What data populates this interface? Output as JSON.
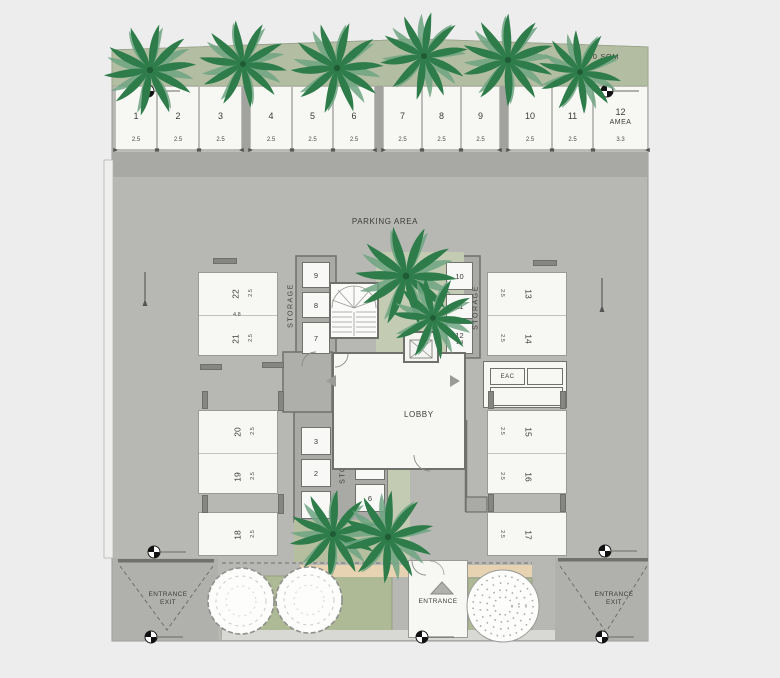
{
  "site": {
    "area_note": "60 SQM",
    "parking_label": "PARKING AREA",
    "entrance": "ENTRANCE",
    "exit_word": "EXIT"
  },
  "core": {
    "lobby": "LOBBY",
    "eac": "EAC",
    "elevator_dim": "1.8"
  },
  "storage": {
    "label": "STORAGE",
    "nw": [
      "9",
      "8",
      "7"
    ],
    "ne": [
      "10",
      "11",
      "12"
    ],
    "ne_last_dim": "1.4",
    "sw": [
      "3",
      "2",
      "1"
    ],
    "se": [
      "4",
      "5",
      "6"
    ]
  },
  "top_row": {
    "stalls": [
      {
        "no": "1",
        "dim": "2.5"
      },
      {
        "no": "2",
        "dim": "2.5"
      },
      {
        "no": "3",
        "dim": "2.5"
      },
      {
        "no": "4",
        "dim": "2.5"
      },
      {
        "no": "5",
        "dim": "2.5"
      },
      {
        "no": "6",
        "dim": "2.5"
      },
      {
        "no": "7",
        "dim": "2.5"
      },
      {
        "no": "8",
        "dim": "2.5"
      },
      {
        "no": "9",
        "dim": "2.5"
      },
      {
        "no": "10",
        "dim": "2.5"
      },
      {
        "no": "11",
        "dim": "2.5"
      },
      {
        "no": "12",
        "dim": "3.3",
        "note": "AMEA"
      }
    ]
  },
  "west": {
    "upper": {
      "a": {
        "no": "22",
        "dim": "2.5"
      },
      "b": {
        "no": "21",
        "dim": "2.5"
      },
      "width_dim": "4.8"
    },
    "lower": {
      "a": {
        "no": "20",
        "dim": "2.5"
      },
      "b": {
        "no": "19",
        "dim": "2.5"
      }
    },
    "single": {
      "no": "18",
      "dim": "2.5"
    }
  },
  "east": {
    "upper": {
      "a": {
        "no": "13",
        "dim": "2.5"
      },
      "b": {
        "no": "14",
        "dim": "2.5"
      }
    },
    "lower": {
      "a": {
        "no": "15",
        "dim": "2.5"
      },
      "b": {
        "no": "16",
        "dim": "2.5"
      }
    },
    "single": {
      "no": "17",
      "dim": "2.5"
    }
  },
  "colors": {
    "surface": "#b7b8b4",
    "drive_band": "#a8a9a5",
    "green_strip": "#b3bda2",
    "courtyard_green": "#c3ccb2",
    "bed_green": "#aeb996",
    "palm_dark": "#2e7c49",
    "palm_light": "#6fa583",
    "tan_walk": "#e7d3b1",
    "stall_white": "#f7f7f4",
    "wall": "#6f706c"
  }
}
